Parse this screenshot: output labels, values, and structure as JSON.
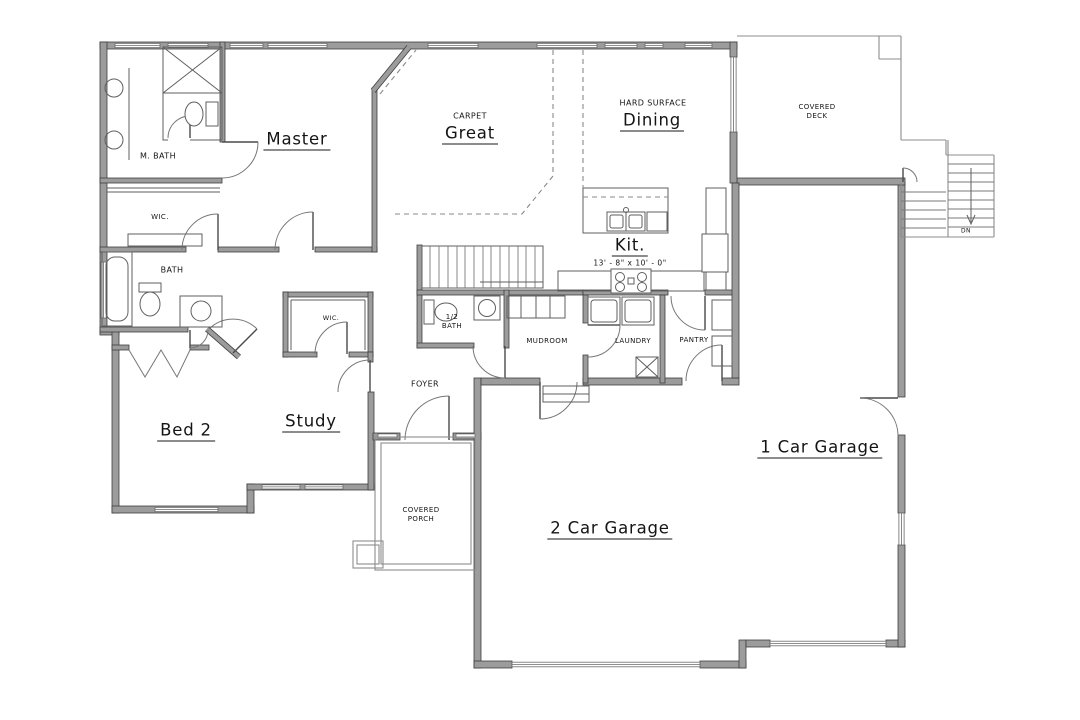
{
  "plan": {
    "rooms": {
      "master": "Master",
      "master_bath": "M. BATH",
      "master_closet": "WIC.",
      "great": "Great",
      "great_surface": "CARPET",
      "dining": "Dining",
      "dining_surface": "HARD SURFACE",
      "kitchen": "Kit.",
      "kitchen_dimensions": "13' - 8\" x 10' - 0\"",
      "covered_deck_line1": "COVERED",
      "covered_deck_line2": "DECK",
      "bath": "BATH",
      "bed2": "Bed 2",
      "study": "Study",
      "study_closet": "WIC.",
      "half_bath_line1": "1/2",
      "half_bath_line2": "BATH",
      "mudroom": "MUDROOM",
      "laundry": "LAUNDRY",
      "pantry": "PANTRY",
      "foyer": "FOYER",
      "covered_porch_line1": "COVERED",
      "covered_porch_line2": "PORCH",
      "garage_2car": "2 Car Garage",
      "garage_1car": "1 Car Garage",
      "stairs_down": "DN"
    },
    "colors": {
      "background": "#ffffff",
      "wall_fill": "#9c9c9c",
      "wall_outline": "#3f3f3f",
      "fixture_line": "#5f5f5f",
      "dashed_line": "#8a8a8a",
      "label_text": "#141414"
    }
  }
}
